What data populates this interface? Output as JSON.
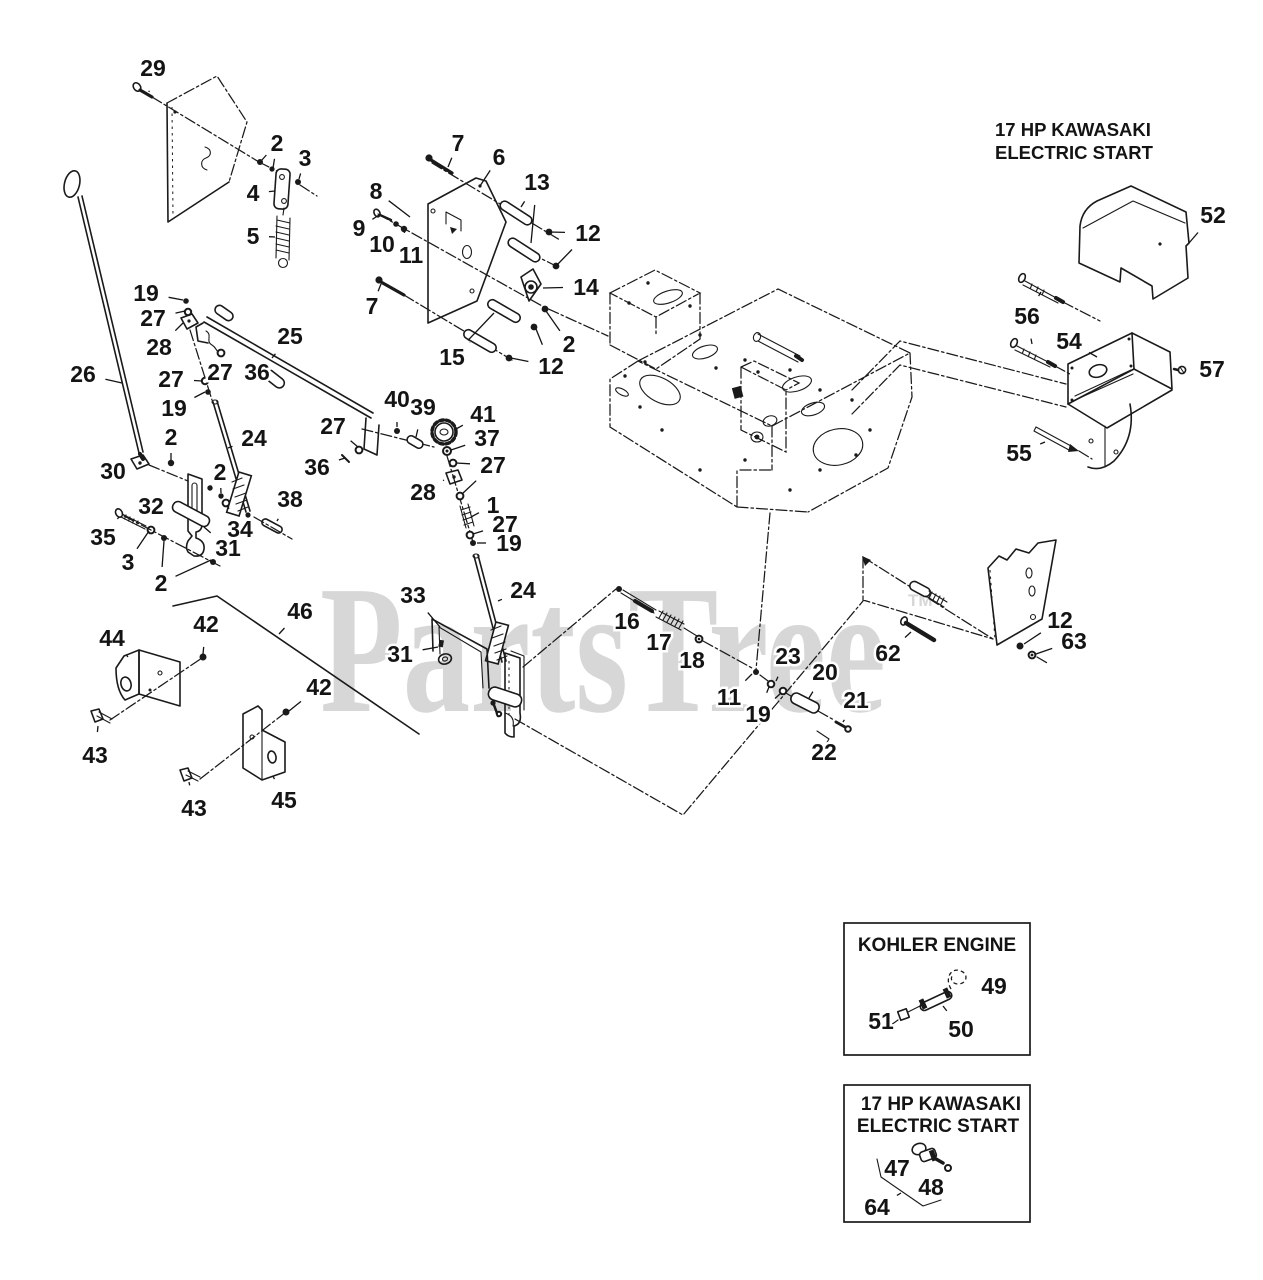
{
  "page": {
    "title": "Exploded parts diagram - engine controls",
    "width": 1263,
    "height": 1280,
    "background": "#ffffff"
  },
  "colors": {
    "line": "#1a1a1a",
    "label": "#141414",
    "watermark": "#d7d7d7"
  },
  "watermark": {
    "text": "PartsTree",
    "trademark": "TM"
  },
  "engine_note": {
    "line1": "17 HP KAWASAKI",
    "line2": "ELECTRIC START"
  },
  "insets": [
    {
      "id": "kohler",
      "title_line1": "KOHLER ENGINE",
      "title_line2": ""
    },
    {
      "id": "kawasaki",
      "title_line1": "17 HP KAWASAKI",
      "title_line2": "ELECTRIC START"
    }
  ],
  "callouts": [
    {
      "n": "29",
      "x": 153,
      "y": 68,
      "t": [
        [
          149,
          92
        ]
      ]
    },
    {
      "n": "2",
      "x": 277,
      "y": 143,
      "t": [
        [
          261,
          161
        ],
        [
          273,
          168
        ]
      ]
    },
    {
      "n": "3",
      "x": 305,
      "y": 158,
      "t": [
        [
          299,
          179
        ]
      ]
    },
    {
      "n": "4",
      "x": 253,
      "y": 193,
      "t": [
        [
          275,
          191
        ]
      ]
    },
    {
      "n": "5",
      "x": 253,
      "y": 236,
      "t": [
        [
          275,
          237
        ]
      ]
    },
    {
      "n": "7",
      "x": 458,
      "y": 143,
      "t": [
        [
          448,
          167
        ]
      ]
    },
    {
      "n": "6",
      "x": 499,
      "y": 157,
      "t": [
        [
          480,
          186
        ]
      ]
    },
    {
      "n": "13",
      "x": 537,
      "y": 182,
      "t": [
        [
          521,
          207
        ],
        [
          531,
          243
        ]
      ]
    },
    {
      "n": "8",
      "x": 376,
      "y": 191,
      "t": [
        [
          410,
          217
        ]
      ]
    },
    {
      "n": "9",
      "x": 359,
      "y": 228,
      "t": [
        [
          379,
          215
        ]
      ]
    },
    {
      "n": "10",
      "x": 382,
      "y": 244,
      "t": [
        [
          395,
          225
        ]
      ]
    },
    {
      "n": "11",
      "x": 411,
      "y": 255,
      "t": [
        [
          404,
          231
        ]
      ]
    },
    {
      "n": "12",
      "x": 588,
      "y": 233,
      "t": [
        [
          549,
          232
        ],
        [
          556,
          266
        ]
      ]
    },
    {
      "n": "14",
      "x": 586,
      "y": 287,
      "t": [
        [
          543,
          288
        ]
      ]
    },
    {
      "n": "7",
      "x": 372,
      "y": 306,
      "t": [
        [
          381,
          284
        ]
      ]
    },
    {
      "n": "15",
      "x": 452,
      "y": 357,
      "t": [
        [
          494,
          313
        ],
        [
          470,
          342
        ]
      ]
    },
    {
      "n": "2",
      "x": 569,
      "y": 344,
      "t": [
        [
          546,
          311
        ]
      ]
    },
    {
      "n": "12",
      "x": 551,
      "y": 366,
      "t": [
        [
          536,
          329
        ],
        [
          511,
          358
        ]
      ]
    },
    {
      "n": "19",
      "x": 146,
      "y": 293,
      "t": [
        [
          183,
          300
        ]
      ]
    },
    {
      "n": "27",
      "x": 153,
      "y": 318,
      "t": [
        [
          185,
          311
        ]
      ]
    },
    {
      "n": "28",
      "x": 159,
      "y": 347,
      "t": [
        [
          183,
          323
        ]
      ]
    },
    {
      "n": "25",
      "x": 290,
      "y": 336,
      "t": [
        [
          272,
          358
        ]
      ]
    },
    {
      "n": "27",
      "x": 220,
      "y": 372,
      "t": [
        [
          221,
          356
        ]
      ]
    },
    {
      "n": "36",
      "x": 257,
      "y": 372,
      "t": [
        [
          267,
          374
        ]
      ]
    },
    {
      "n": "27",
      "x": 171,
      "y": 379,
      "t": [
        [
          202,
          381
        ]
      ]
    },
    {
      "n": "19",
      "x": 174,
      "y": 408,
      "t": [
        [
          205,
          392
        ]
      ]
    },
    {
      "n": "26",
      "x": 83,
      "y": 374,
      "t": [
        [
          122,
          383
        ]
      ]
    },
    {
      "n": "2",
      "x": 171,
      "y": 437,
      "t": [
        [
          171,
          460
        ]
      ]
    },
    {
      "n": "24",
      "x": 254,
      "y": 438,
      "t": [
        [
          228,
          448
        ]
      ]
    },
    {
      "n": "30",
      "x": 113,
      "y": 471,
      "t": [
        [
          133,
          465
        ]
      ]
    },
    {
      "n": "2",
      "x": 220,
      "y": 472,
      "t": [
        [
          211,
          486
        ],
        [
          221,
          493
        ]
      ]
    },
    {
      "n": "32",
      "x": 151,
      "y": 506,
      "t": [
        [
          173,
          508
        ]
      ]
    },
    {
      "n": "35",
      "x": 103,
      "y": 537,
      "t": [
        [
          119,
          517
        ]
      ]
    },
    {
      "n": "3",
      "x": 128,
      "y": 562,
      "t": [
        [
          149,
          531
        ]
      ]
    },
    {
      "n": "2",
      "x": 161,
      "y": 583,
      "t": [
        [
          164,
          541
        ],
        [
          211,
          560
        ]
      ]
    },
    {
      "n": "34",
      "x": 240,
      "y": 529,
      "t": [
        [
          227,
          505
        ]
      ]
    },
    {
      "n": "31",
      "x": 228,
      "y": 548,
      "t": [
        [
          204,
          527
        ]
      ]
    },
    {
      "n": "38",
      "x": 290,
      "y": 499,
      "t": [
        [
          277,
          521
        ]
      ]
    },
    {
      "n": "27",
      "x": 333,
      "y": 426,
      "t": [
        [
          358,
          447
        ]
      ]
    },
    {
      "n": "36",
      "x": 317,
      "y": 467,
      "t": [
        [
          345,
          458
        ]
      ]
    },
    {
      "n": "40",
      "x": 397,
      "y": 399,
      "t": [
        [
          397,
          427
        ]
      ]
    },
    {
      "n": "39",
      "x": 423,
      "y": 407,
      "t": [
        [
          416,
          437
        ]
      ]
    },
    {
      "n": "41",
      "x": 483,
      "y": 414,
      "t": [
        [
          456,
          429
        ]
      ]
    },
    {
      "n": "37",
      "x": 487,
      "y": 438,
      "t": [
        [
          451,
          450
        ]
      ]
    },
    {
      "n": "27",
      "x": 493,
      "y": 465,
      "t": [
        [
          456,
          463
        ],
        [
          462,
          494
        ]
      ]
    },
    {
      "n": "28",
      "x": 423,
      "y": 492,
      "t": [
        [
          444,
          480
        ]
      ]
    },
    {
      "n": "1",
      "x": 493,
      "y": 505,
      "t": [
        [
          471,
          517
        ]
      ]
    },
    {
      "n": "27",
      "x": 505,
      "y": 524,
      "t": [
        [
          473,
          534
        ]
      ]
    },
    {
      "n": "19",
      "x": 509,
      "y": 543,
      "t": [
        [
          477,
          543
        ]
      ]
    },
    {
      "n": "24",
      "x": 523,
      "y": 590,
      "t": [
        [
          498,
          601
        ]
      ]
    },
    {
      "n": "33",
      "x": 413,
      "y": 595,
      "t": [
        [
          440,
          627
        ]
      ]
    },
    {
      "n": "31",
      "x": 400,
      "y": 654,
      "t": [
        [
          438,
          647
        ]
      ]
    },
    {
      "n": "44",
      "x": 112,
      "y": 638,
      "t": [
        [
          128,
          657
        ]
      ]
    },
    {
      "n": "42",
      "x": 206,
      "y": 624,
      "t": [
        [
          203,
          654
        ]
      ]
    },
    {
      "n": "46",
      "x": 300,
      "y": 611,
      "t": [
        [
          279,
          634
        ]
      ]
    },
    {
      "n": "43",
      "x": 95,
      "y": 755,
      "t": [
        [
          98,
          726
        ]
      ]
    },
    {
      "n": "42",
      "x": 319,
      "y": 687,
      "t": [
        [
          289,
          711
        ]
      ]
    },
    {
      "n": "45",
      "x": 284,
      "y": 800,
      "t": [
        [
          273,
          776
        ]
      ]
    },
    {
      "n": "43",
      "x": 194,
      "y": 808,
      "t": [
        [
          189,
          782
        ]
      ]
    },
    {
      "n": "16",
      "x": 627,
      "y": 621,
      "t": [
        [
          636,
          603
        ]
      ]
    },
    {
      "n": "17",
      "x": 659,
      "y": 642,
      "t": [
        [
          668,
          624
        ]
      ]
    },
    {
      "n": "18",
      "x": 692,
      "y": 660,
      "t": [
        [
          698,
          643
        ]
      ]
    },
    {
      "n": "11",
      "x": 729,
      "y": 697,
      "t": [
        [
          752,
          674
        ]
      ]
    },
    {
      "n": "23",
      "x": 788,
      "y": 656,
      "t": [
        [
          776,
          681
        ]
      ]
    },
    {
      "n": "19",
      "x": 758,
      "y": 714,
      "t": [
        [
          769,
          687
        ],
        [
          781,
          693
        ]
      ]
    },
    {
      "n": "20",
      "x": 825,
      "y": 672,
      "t": [
        [
          809,
          698
        ]
      ]
    },
    {
      "n": "21",
      "x": 856,
      "y": 700,
      "t": [
        [
          843,
          722
        ]
      ]
    },
    {
      "n": "22",
      "x": 824,
      "y": 752,
      "t": [
        [
          824,
          742
        ]
      ]
    },
    {
      "n": "62",
      "x": 888,
      "y": 653,
      "t": [
        [
          911,
          632
        ]
      ]
    },
    {
      "n": "12",
      "x": 1060,
      "y": 620,
      "t": [
        [
          1024,
          644
        ]
      ]
    },
    {
      "n": "63",
      "x": 1074,
      "y": 641,
      "t": [
        [
          1036,
          654
        ]
      ]
    },
    {
      "n": "52",
      "x": 1213,
      "y": 215,
      "t": [
        [
          1189,
          243
        ]
      ]
    },
    {
      "n": "56",
      "x": 1027,
      "y": 316,
      "t": [
        [
          1041,
          292
        ],
        [
          1032,
          344
        ]
      ]
    },
    {
      "n": "54",
      "x": 1069,
      "y": 341,
      "t": [
        [
          1097,
          357
        ]
      ]
    },
    {
      "n": "57",
      "x": 1212,
      "y": 369,
      "t": [
        [
          1189,
          369
        ]
      ]
    },
    {
      "n": "55",
      "x": 1019,
      "y": 453,
      "t": [
        [
          1045,
          442
        ]
      ]
    },
    {
      "n": "49",
      "x": 994,
      "y": 986,
      "t": [
        [
          973,
          982
        ]
      ]
    },
    {
      "n": "50",
      "x": 961,
      "y": 1029,
      "t": [
        [
          943,
          1006
        ]
      ]
    },
    {
      "n": "51",
      "x": 881,
      "y": 1021,
      "t": [
        [
          898,
          1018
        ]
      ]
    },
    {
      "n": "47",
      "x": 897,
      "y": 1168,
      "t": [
        [
          914,
          1154
        ]
      ]
    },
    {
      "n": "48",
      "x": 931,
      "y": 1187,
      "t": [
        [
          944,
          1172
        ]
      ]
    },
    {
      "n": "64",
      "x": 877,
      "y": 1207,
      "t": [
        [
          901,
          1193
        ]
      ]
    }
  ]
}
